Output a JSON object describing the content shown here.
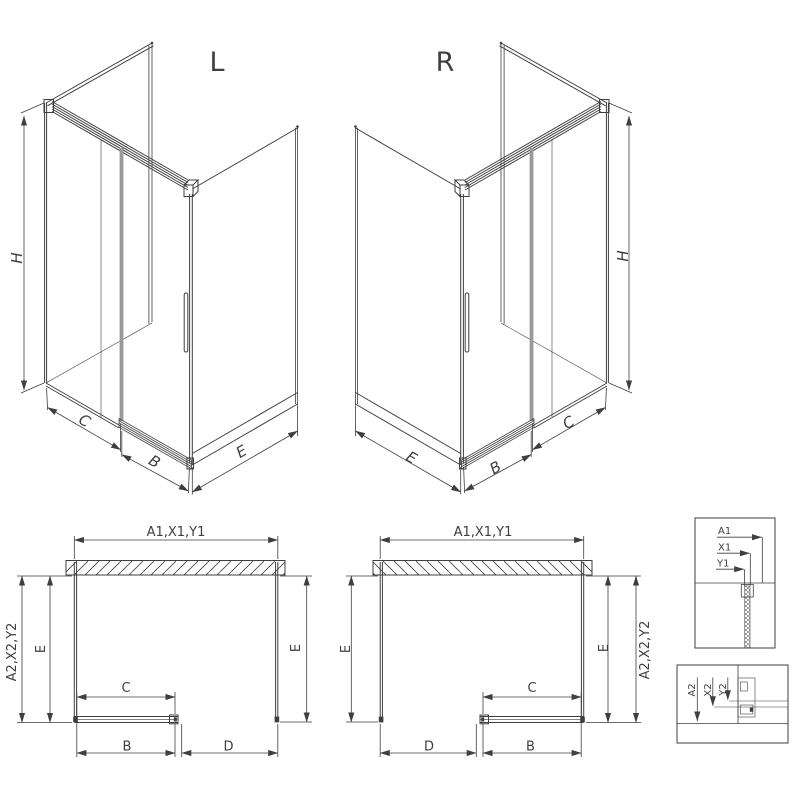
{
  "drawing": {
    "iso_left": {
      "variant": "L",
      "height": "H",
      "fixed_width": "C",
      "door_width": "B",
      "side_width": "E"
    },
    "iso_right": {
      "variant": "R",
      "height": "H",
      "fixed_width": "C",
      "door_width": "B",
      "side_width": "E"
    },
    "plan_left": {
      "total_width": "A1,X1,Y1",
      "total_depth": "A2,X2,Y2",
      "depth_left": "E",
      "depth_right": "E",
      "fixed_width": "C",
      "door_width": "B",
      "entry_width": "D"
    },
    "plan_right": {
      "total_width": "A1,X1,Y1",
      "total_depth": "A2,X2,Y2",
      "depth_left": "E",
      "depth_right": "E",
      "fixed_width": "C",
      "door_width": "B",
      "entry_width": "D"
    },
    "detail_top": {
      "dim_a": "A1",
      "dim_x": "X1",
      "dim_y": "Y1"
    },
    "detail_bottom": {
      "dim_a": "A2",
      "dim_x": "X2",
      "dim_y": "Y2"
    },
    "colors": {
      "line": "#3f3f3f",
      "door_profile_gray": "#9a9a9a",
      "background": "#ffffff"
    }
  }
}
